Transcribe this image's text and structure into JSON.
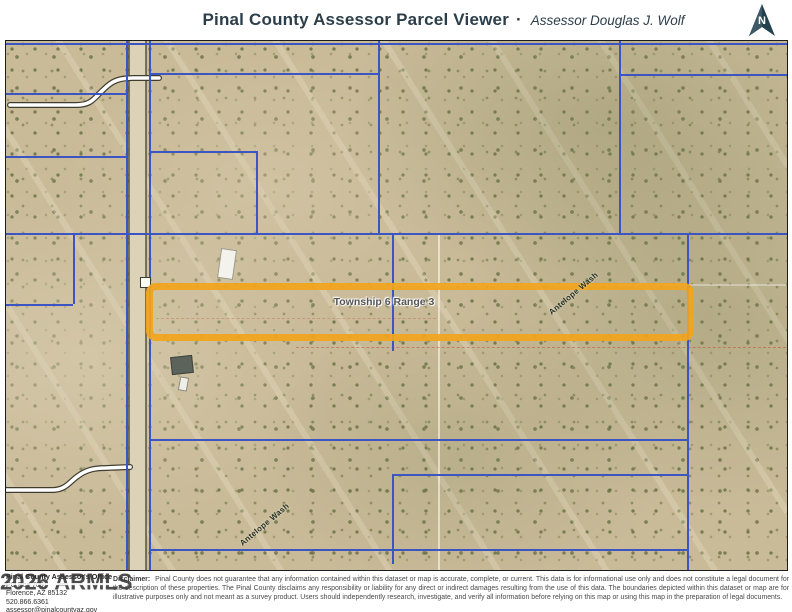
{
  "header": {
    "title": "Pinal County Assessor Parcel Viewer",
    "separator": "·",
    "subtitle": "Assessor Douglas J. Wolf",
    "north_label": "N"
  },
  "map": {
    "township_label": "Township 6 Range 3",
    "wash_label_upper": "Antelope Wash",
    "wash_label_lower": "Antelope Wash",
    "colors": {
      "highlight": "#F2A41C",
      "parcel_line": "#3D55C3",
      "terrain": "#C9BA98"
    }
  },
  "footer": {
    "office": {
      "name": "Pinal County Assessor's Office",
      "po_box": "PO Box 709",
      "city": "Florence, AZ 85132",
      "phone": "520.866.6361",
      "email": "assessor@pinalcountyaz.gov"
    },
    "watermark": "2026 ARMLS",
    "disclaimer_label": "Disclaimer:",
    "disclaimer_text": "Pinal County does not guarantee that any information contained within this dataset or map is accurate, complete, or current. This data is for informational use only and does not constitute a legal document for the description of these properties. The Pinal County disclaims any responsibility or liability for any direct or indirect damages resulting from the use of this data. The boundaries depicted within this dataset or map are for illustrative purposes only and not meant as a survey product. Users should independently research, investigate, and verify all information before relying on this map or using this map in the preparation of legal documents."
  }
}
